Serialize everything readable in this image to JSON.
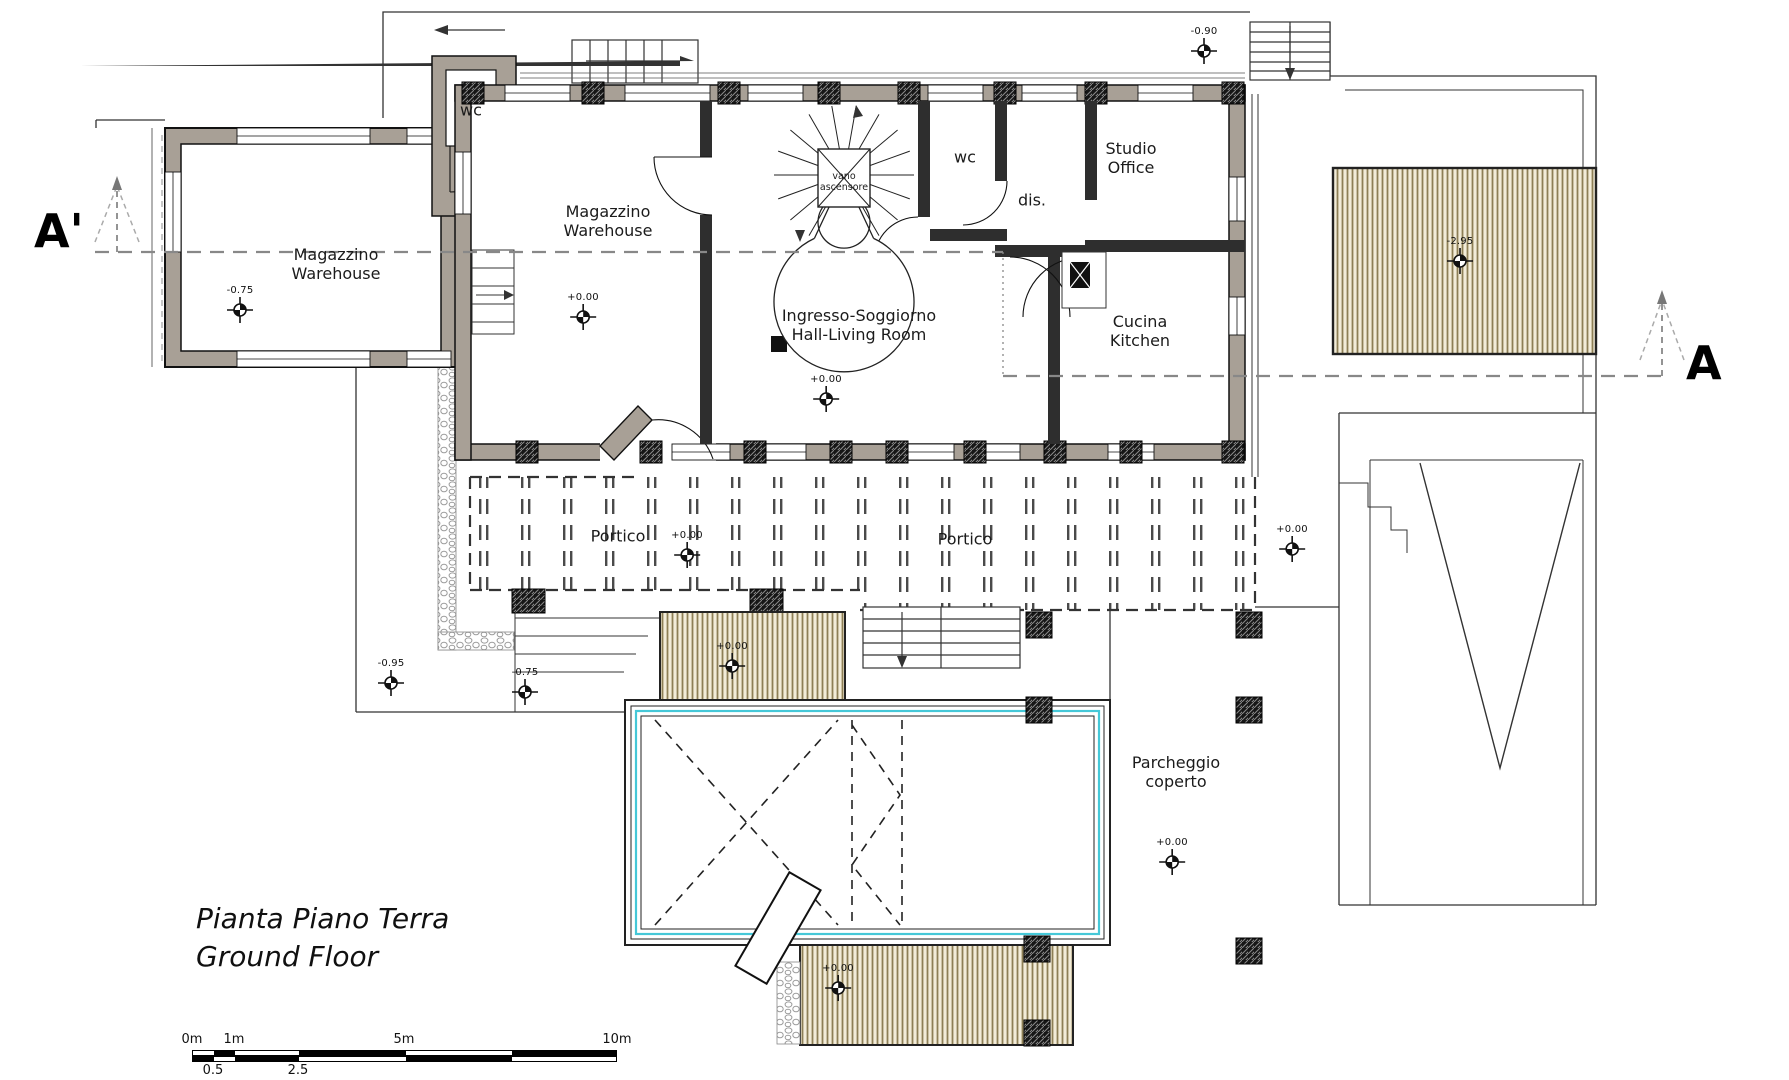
{
  "title": {
    "line1": "Pianta Piano Terra",
    "line2": "Ground Floor"
  },
  "section_markers": {
    "left": "A'",
    "right": "A"
  },
  "rooms": [
    {
      "id": "magazzino-left",
      "lines": [
        "Magazzino",
        "Warehouse"
      ],
      "x": 336,
      "y": 264
    },
    {
      "id": "wc-north",
      "lines": [
        "wc"
      ],
      "x": 471,
      "y": 110
    },
    {
      "id": "magazzino-main",
      "lines": [
        "Magazzino",
        "Warehouse"
      ],
      "x": 608,
      "y": 221
    },
    {
      "id": "vano-ascensore",
      "lines": [
        "vano",
        "ascensore"
      ],
      "x": 844,
      "y": 183,
      "size": "small"
    },
    {
      "id": "wc-center",
      "lines": [
        "wc"
      ],
      "x": 965,
      "y": 157
    },
    {
      "id": "dis",
      "lines": [
        "dis."
      ],
      "x": 1032,
      "y": 200
    },
    {
      "id": "studio-office",
      "lines": [
        "Studio",
        "Office"
      ],
      "x": 1131,
      "y": 158
    },
    {
      "id": "cucina-kitchen",
      "lines": [
        "Cucina",
        "Kitchen"
      ],
      "x": 1140,
      "y": 331
    },
    {
      "id": "ingresso-soggiorno",
      "lines": [
        "Ingresso-Soggiorno",
        "Hall-Living Room"
      ],
      "x": 859,
      "y": 325
    },
    {
      "id": "portico-left",
      "lines": [
        "Portico"
      ],
      "x": 618,
      "y": 536
    },
    {
      "id": "portico-right",
      "lines": [
        "Portico"
      ],
      "x": 965,
      "y": 539
    },
    {
      "id": "parcheggio-coperto",
      "lines": [
        "Parcheggio",
        "coperto"
      ],
      "x": 1176,
      "y": 772
    }
  ],
  "elevation_markers": [
    {
      "value": "-0.75",
      "x": 240,
      "y": 311
    },
    {
      "value": "+0.00",
      "x": 583,
      "y": 318
    },
    {
      "value": "+0.00",
      "x": 826,
      "y": 400
    },
    {
      "value": "-0.90",
      "x": 1204,
      "y": 52
    },
    {
      "value": "-2.95",
      "x": 1460,
      "y": 262
    },
    {
      "value": "+0.00",
      "x": 687,
      "y": 556
    },
    {
      "value": "+0.00",
      "x": 1292,
      "y": 550
    },
    {
      "value": "-0.95",
      "x": 391,
      "y": 684
    },
    {
      "value": "-0.75",
      "x": 525,
      "y": 693
    },
    {
      "value": "+0.00",
      "x": 732,
      "y": 667
    },
    {
      "value": "+0.00",
      "x": 838,
      "y": 989
    },
    {
      "value": "+0.00",
      "x": 1172,
      "y": 863
    }
  ],
  "scale_bar": {
    "top_ticks": [
      {
        "label": "0m",
        "x": 192
      },
      {
        "label": "1m",
        "x": 234
      },
      {
        "label": "5m",
        "x": 404
      },
      {
        "label": "10m",
        "x": 617
      }
    ],
    "bottom_ticks": [
      {
        "label": "0.5",
        "x": 213
      },
      {
        "label": "2.5",
        "x": 298
      }
    ]
  },
  "colors": {
    "wall_fill": "#a8a096",
    "deck_stripe": "#8d7f55",
    "pool_water_line": "#45c8d8",
    "section_line": "#888888"
  }
}
